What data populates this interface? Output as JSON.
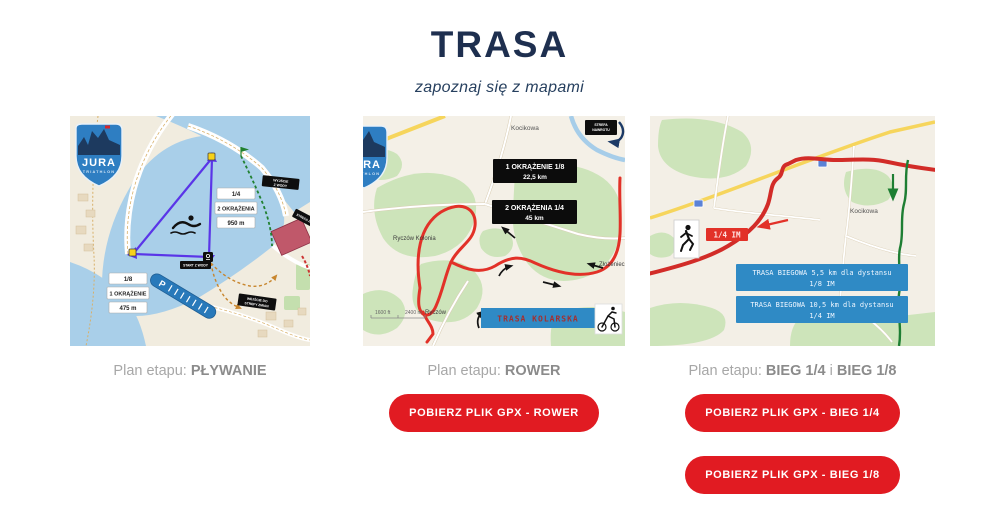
{
  "header": {
    "title": "TRASA",
    "subtitle": "zapoznaj się z mapami"
  },
  "colors": {
    "title_navy": "#1e2f4f",
    "button_red": "#e11b22",
    "banner_blue": "#2f8ac5",
    "route_red": "#e23128",
    "route_green": "#1e7e33",
    "swim_purple": "#5a35e8",
    "caption_gray": "#a7a7a7"
  },
  "columns": [
    {
      "caption": {
        "prefix": "Plan etapu: ",
        "bold1": "PŁYWANIE",
        "sep": "",
        "bold2": ""
      },
      "buttons": [],
      "map": {
        "logo": {
          "line1": "JURA",
          "line2": "TRIATHLON"
        },
        "box_quarter": {
          "fraction": "1/4",
          "laps": "2 OKRĄŻENIA",
          "distance": "950 m"
        },
        "box_eighth": {
          "fraction": "1/8",
          "laps": "1 OKRĄŻENIE",
          "distance": "475 m"
        },
        "labels": {
          "water_exit_line1": "WYJŚCIE",
          "water_exit_line2": "Z WODY",
          "zone": "STREFA ZMIAN",
          "start": "START Z WODY",
          "entry_line1": "WEJŚCIE DO",
          "entry_line2": "STREFY ZMIAN",
          "parking": "P"
        }
      }
    },
    {
      "caption": {
        "prefix": "Plan etapu: ",
        "bold1": "ROWER",
        "sep": "",
        "bold2": ""
      },
      "buttons": [
        "POBIERZ PLIK GPX - ROWER"
      ],
      "map": {
        "logo": {
          "line1": "JURA",
          "line2": "TRIATHLON"
        },
        "place_top": "Kocikowa",
        "lap1_line1": "1 OKRĄŻENIE  1/8",
        "lap1_line2": "22,5 km",
        "lap2_line1": "2 OKRĄŻENIA  1/4",
        "lap2_line2": "45 km",
        "place_left": "Ryczów Kolonia",
        "place_bottom": "Ryczów",
        "place_right": "Złożeniec",
        "turn_line1": "STREFA",
        "turn_line2": "NAWROTU",
        "scale_left": "1600 ft",
        "scale_right": "2400 m",
        "banner": "TRASA KOLARSKA"
      }
    },
    {
      "caption": {
        "prefix": "Plan etapu: ",
        "bold1": "BIEG 1/4",
        "sep": " i ",
        "bold2": "BIEG 1/8"
      },
      "buttons": [
        "POBIERZ PLIK GPX - BIEG 1/4",
        "POBIERZ PLIK GPX - BIEG 1/8"
      ],
      "map": {
        "place": "Kocikowa",
        "badge": "1/4 IM",
        "banner1_line1": "TRASA BIEGOWA 5,5 km dla dystansu",
        "banner1_line2": "1/8 IM",
        "banner2_line1": "TRASA BIEGOWA 10,5 km dla dystansu",
        "banner2_line2": "1/4 IM"
      }
    }
  ]
}
